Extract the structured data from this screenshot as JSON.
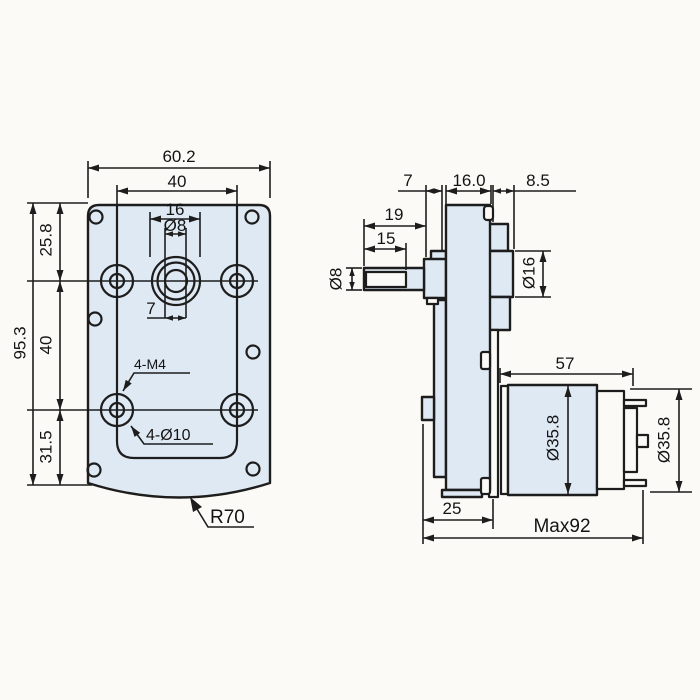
{
  "drawing": {
    "type": "gear-motor-dimension-drawing",
    "colors": {
      "part_fill": "#dfe9f3",
      "line": "#1d1d1d",
      "background": "#fbfaf6"
    },
    "front_view": {
      "width": "60.2",
      "hole_span": "40",
      "boss": "16",
      "shaft_dia": "Ø8",
      "shaft_flat": "7",
      "top": "25.8",
      "mid": "40",
      "bottom": "31.5",
      "height": "95.3",
      "tapped": "4-M4",
      "through": "4-Ø10",
      "radius": "R70"
    },
    "side_view": {
      "collar": "7",
      "case": "16.0",
      "boss_len": "8.5",
      "shaft_len": "19",
      "flat_len": "15",
      "shaft_dia": "Ø8",
      "boss_dia": "Ø16",
      "motor_len": "57",
      "motor_dia": "Ø35.8",
      "motor_dia_rear": "Ø35.8",
      "base": "25",
      "overall": "Max92"
    }
  }
}
